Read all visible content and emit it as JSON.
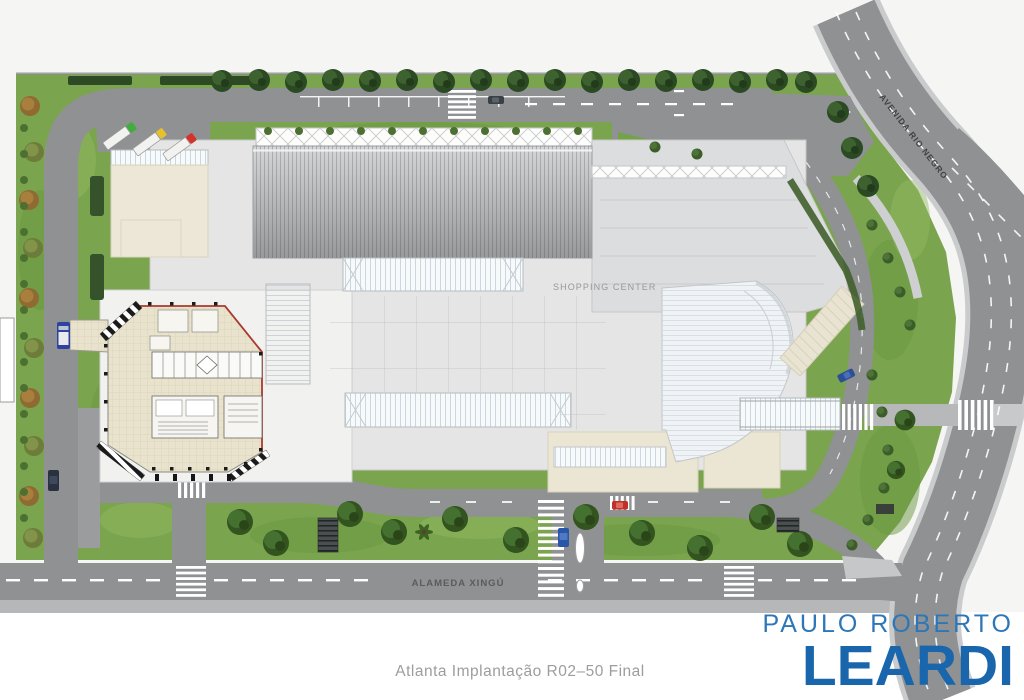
{
  "page": {
    "background": "#f6f6f4"
  },
  "plan": {
    "labels": {
      "building": "SHOPPING CENTER",
      "street_avenue": "AVENIDA RIO NEGRO",
      "street_boulevard": "ALAMEDA XINGÚ"
    },
    "colors": {
      "grass": "#7aa44d",
      "road": "#8f9193",
      "sidewalk": "#c6c8c9",
      "mall_slab": "#e4e5e4",
      "roof_gray": "#a9abad",
      "beige": "#ece7d6",
      "tower_floor": "#e9e2cc",
      "tower_outline_red": "#a93a30",
      "tree_dark": "#2b4923",
      "tree_autumn": "#8f6a33"
    },
    "vehicles": [
      {
        "type": "truck",
        "color": "green",
        "location": "loading dock"
      },
      {
        "type": "truck",
        "color": "yellow",
        "location": "loading dock"
      },
      {
        "type": "truck",
        "color": "red",
        "location": "loading dock"
      },
      {
        "type": "car",
        "color": "dark-gray",
        "location": "top road"
      },
      {
        "type": "van",
        "color": "blue",
        "location": "left road"
      },
      {
        "type": "car",
        "color": "dark-blue",
        "location": "left road parking"
      },
      {
        "type": "car",
        "color": "blue",
        "location": "south entrance"
      },
      {
        "type": "car",
        "color": "red",
        "location": "service road crossing"
      },
      {
        "type": "car",
        "color": "blue",
        "location": "east loop road"
      }
    ]
  },
  "caption": {
    "text": "Atlanta Implantação R02–50 Final"
  },
  "logo": {
    "line1": "PAULO ROBERTO",
    "line2": "LEARDI",
    "color_primary": "#1a66ad",
    "color_secondary": "#2d77b9"
  }
}
